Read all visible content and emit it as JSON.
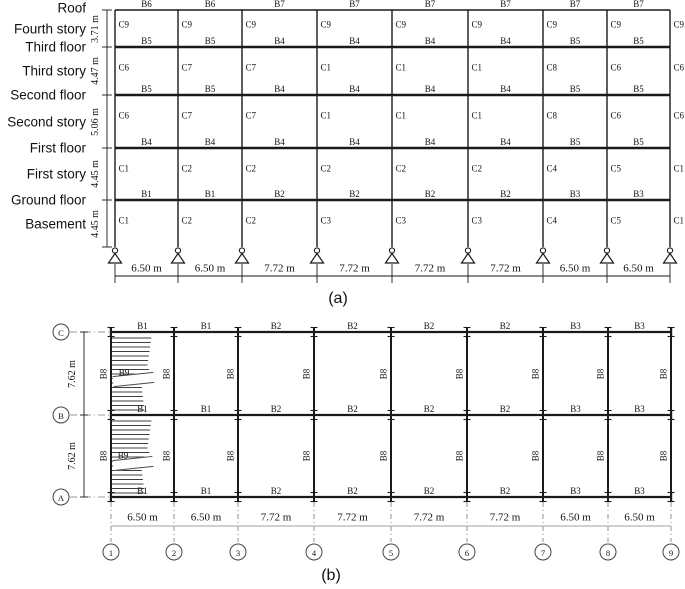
{
  "figure": {
    "elevation": {
      "caption": "(a)",
      "story_labels": [
        "Roof",
        "Fourth story",
        "Third floor",
        "Third story",
        "Second floor",
        "Second story",
        "First floor",
        "First story",
        "Ground floor",
        "Basement"
      ],
      "story_heights": [
        "3.71 m",
        "4.47 m",
        "5.06 m",
        "4.45 m",
        "4.45 m"
      ],
      "bay_widths": [
        "6.50 m",
        "6.50 m",
        "7.72 m",
        "7.72 m",
        "7.72 m",
        "7.72 m",
        "6.50 m",
        "6.50 m"
      ],
      "beam_rows": [
        {
          "level": "roof",
          "labels": [
            "B6",
            "B6",
            "B7",
            "B7",
            "B7",
            "B7",
            "B7",
            "B7"
          ]
        },
        {
          "level": "third-floor",
          "labels": [
            "B5",
            "B5",
            "B4",
            "B4",
            "B4",
            "B4",
            "B5",
            "B5"
          ]
        },
        {
          "level": "second-floor",
          "labels": [
            "B5",
            "B5",
            "B4",
            "B4",
            "B4",
            "B4",
            "B5",
            "B5"
          ]
        },
        {
          "level": "first-floor",
          "labels": [
            "B4",
            "B4",
            "B4",
            "B4",
            "B4",
            "B4",
            "B5",
            "B5"
          ]
        },
        {
          "level": "ground-floor",
          "labels": [
            "B1",
            "B1",
            "B2",
            "B2",
            "B2",
            "B2",
            "B3",
            "B3"
          ]
        }
      ],
      "column_rows": [
        {
          "story": "fourth-story",
          "labels": [
            "C9",
            "C9",
            "C9",
            "C9",
            "C9",
            "C9",
            "C9",
            "C9",
            "C9"
          ]
        },
        {
          "story": "third-story",
          "labels": [
            "C6",
            "C7",
            "C7",
            "C1",
            "C1",
            "C1",
            "C8",
            "C6",
            "C6"
          ]
        },
        {
          "story": "second-story",
          "labels": [
            "C6",
            "C7",
            "C7",
            "C1",
            "C1",
            "C1",
            "C8",
            "C6",
            "C6"
          ]
        },
        {
          "story": "first-story",
          "labels": [
            "C1",
            "C2",
            "C2",
            "C2",
            "C2",
            "C2",
            "C4",
            "C5",
            "C1"
          ]
        },
        {
          "story": "basement",
          "labels": [
            "C1",
            "C2",
            "C2",
            "C3",
            "C3",
            "C3",
            "C4",
            "C5",
            "C1"
          ]
        }
      ]
    },
    "plan": {
      "caption": "(b)",
      "row_lines": [
        "C",
        "B",
        "A"
      ],
      "col_lines": [
        "1",
        "2",
        "3",
        "4",
        "5",
        "6",
        "7",
        "8",
        "9"
      ],
      "row_spacings": [
        "7.62 m",
        "7.62 m"
      ],
      "bay_widths": [
        "6.50 m",
        "6.50 m",
        "7.72 m",
        "7.72 m",
        "7.72 m",
        "7.72 m",
        "6.50 m",
        "6.50 m"
      ],
      "beam_rows": [
        {
          "line": "C",
          "labels": [
            "B1",
            "B1",
            "B2",
            "B2",
            "B2",
            "B2",
            "B3",
            "B3"
          ]
        },
        {
          "line": "B",
          "labels": [
            "B1",
            "B1",
            "B2",
            "B2",
            "B2",
            "B2",
            "B3",
            "B3"
          ]
        },
        {
          "line": "A",
          "labels": [
            "B1",
            "B1",
            "B2",
            "B2",
            "B2",
            "B2",
            "B3",
            "B3"
          ]
        }
      ],
      "cross_beam_label": "B8",
      "stair_beam_label": "B9"
    }
  }
}
